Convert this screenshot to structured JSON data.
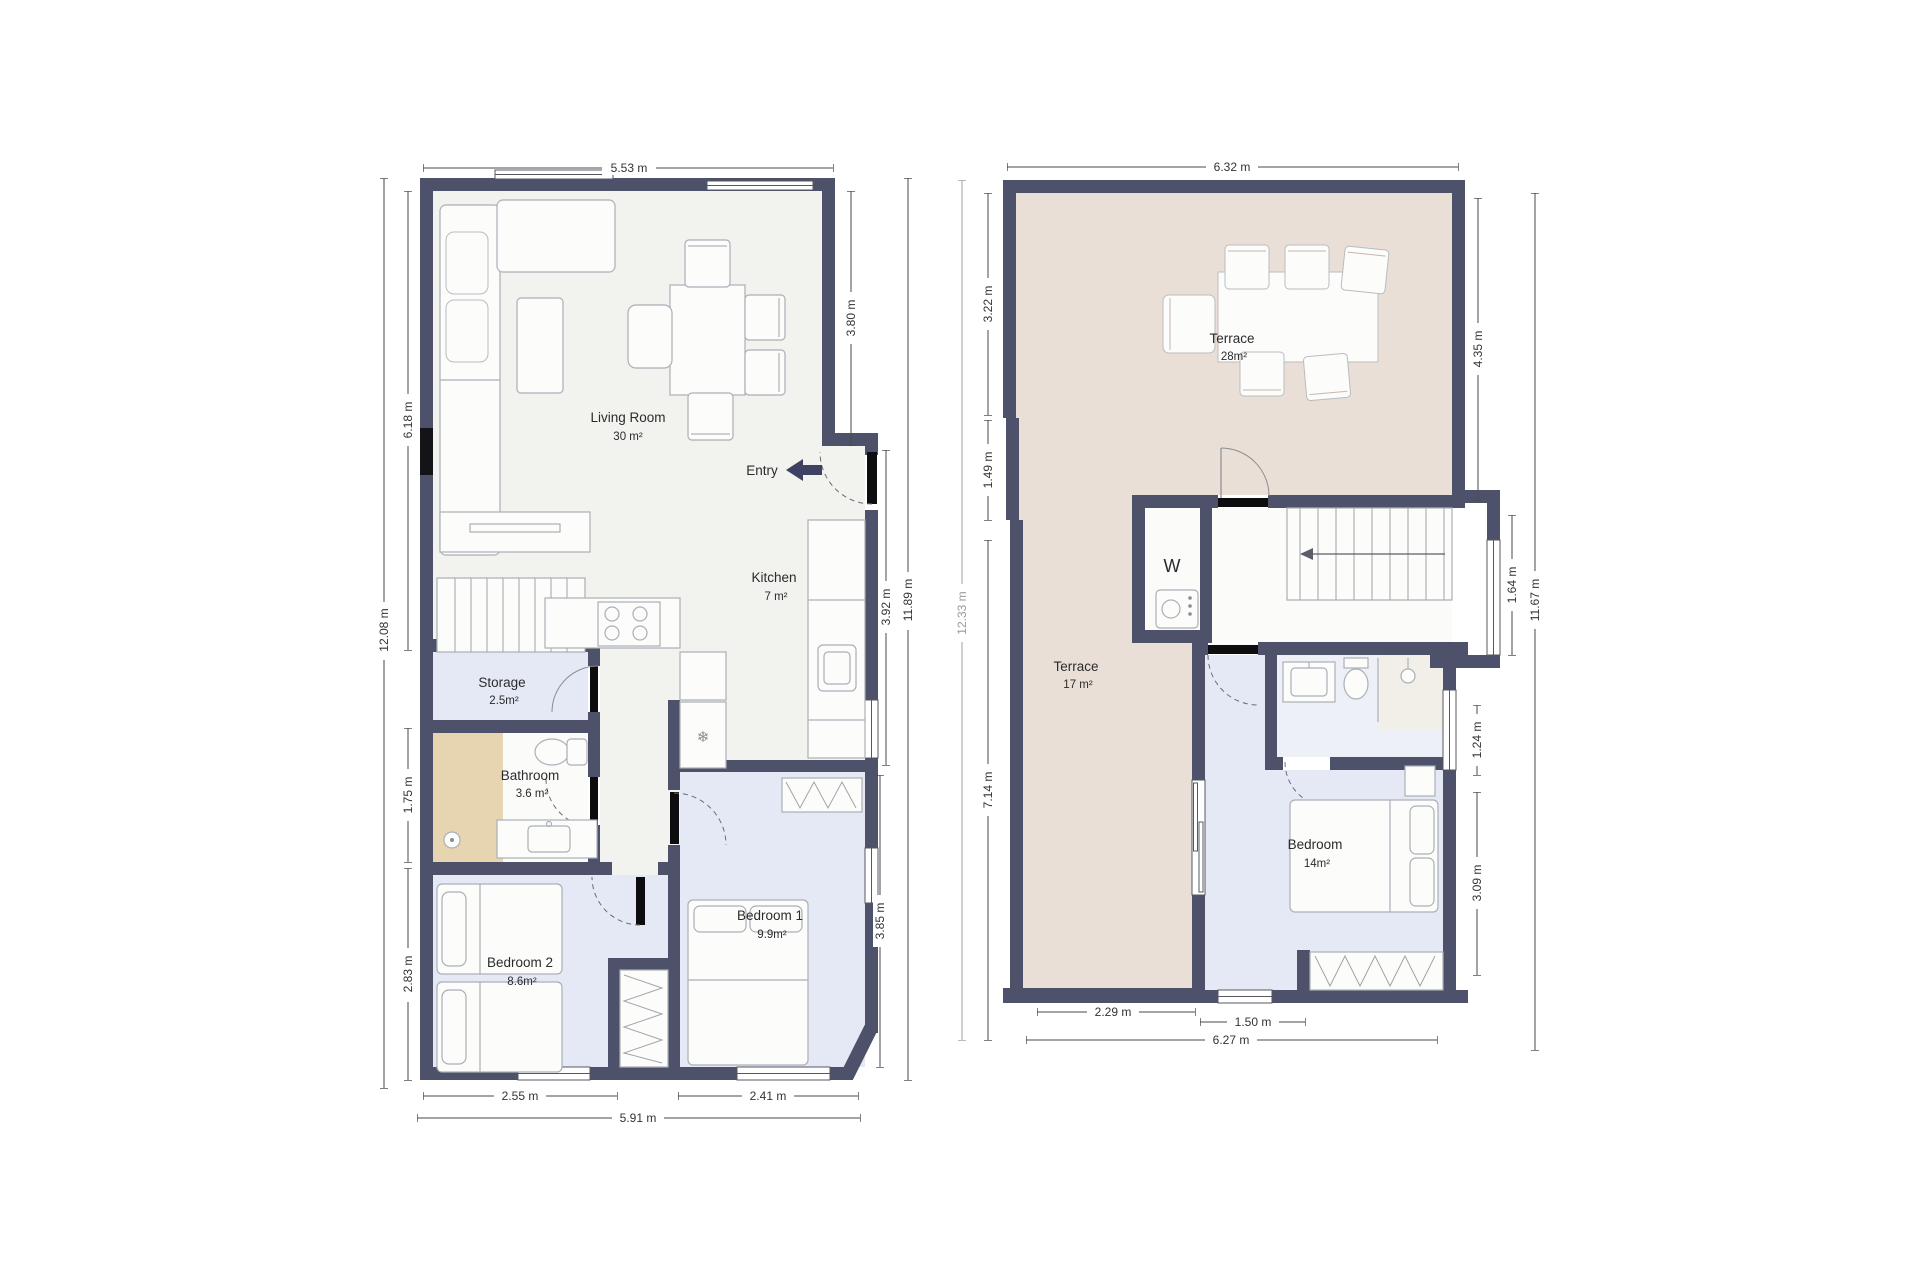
{
  "title": "Two-storey apartment floor plans",
  "colors": {
    "wall": "#4d5169",
    "floor_living": "#f2f2ee",
    "floor_bedroom": "#e4e9f5",
    "floor_terrace": "#eadfd6",
    "floor_shower_tan": "#e7d5b2",
    "dim_text": "#333333"
  },
  "left_plan": {
    "rooms": {
      "living": {
        "name": "Living Room",
        "area": "30 m²"
      },
      "kitchen": {
        "name": "Kitchen",
        "area": "7 m²"
      },
      "storage": {
        "name": "Storage",
        "area": "2.5m²"
      },
      "bathroom": {
        "name": "Bathroom",
        "area": "3.6 m²"
      },
      "bedroom1": {
        "name": "Bedroom 1",
        "area": "9.9m²"
      },
      "bedroom2": {
        "name": "Bedroom 2",
        "area": "8.6m²"
      }
    },
    "entry": "Entry",
    "dims": {
      "top": "5.53 m",
      "left_living": "6.18 m",
      "left_total": "12.08 m",
      "left_bath": "1.75 m",
      "left_beds": "2.83 m",
      "right_living": "3.80 m",
      "right_kitchen": "3.92 m",
      "right_total": "11.89 m",
      "right_bed1": "3.85 m",
      "bottom_bed2": "2.55 m",
      "bottom_bed1": "2.41 m",
      "bottom_total": "5.91 m"
    }
  },
  "right_plan": {
    "rooms": {
      "terrace_upper": {
        "name": "Terrace",
        "area": "28m²"
      },
      "terrace_lower": {
        "name": "Terrace",
        "area": "17 m²"
      },
      "bedroom": {
        "name": "Bedroom",
        "area": "14m²"
      },
      "washer": "W"
    },
    "dims": {
      "top": "6.32 m",
      "left_upper": "3.22 m",
      "left_mid": "1.49 m",
      "left_total": "12.33 m",
      "left_lower": "7.14 m",
      "right_terrace": "4.35 m",
      "right_stairwin": "1.64 m",
      "right_total": "11.67 m",
      "right_bathwin": "1.24 m",
      "right_bedroom": "3.09 m",
      "bottom_terrace": "2.29 m",
      "bottom_window": "1.50 m",
      "bottom_total": "6.27 m"
    }
  },
  "icons": {
    "snowflake": "❄"
  }
}
